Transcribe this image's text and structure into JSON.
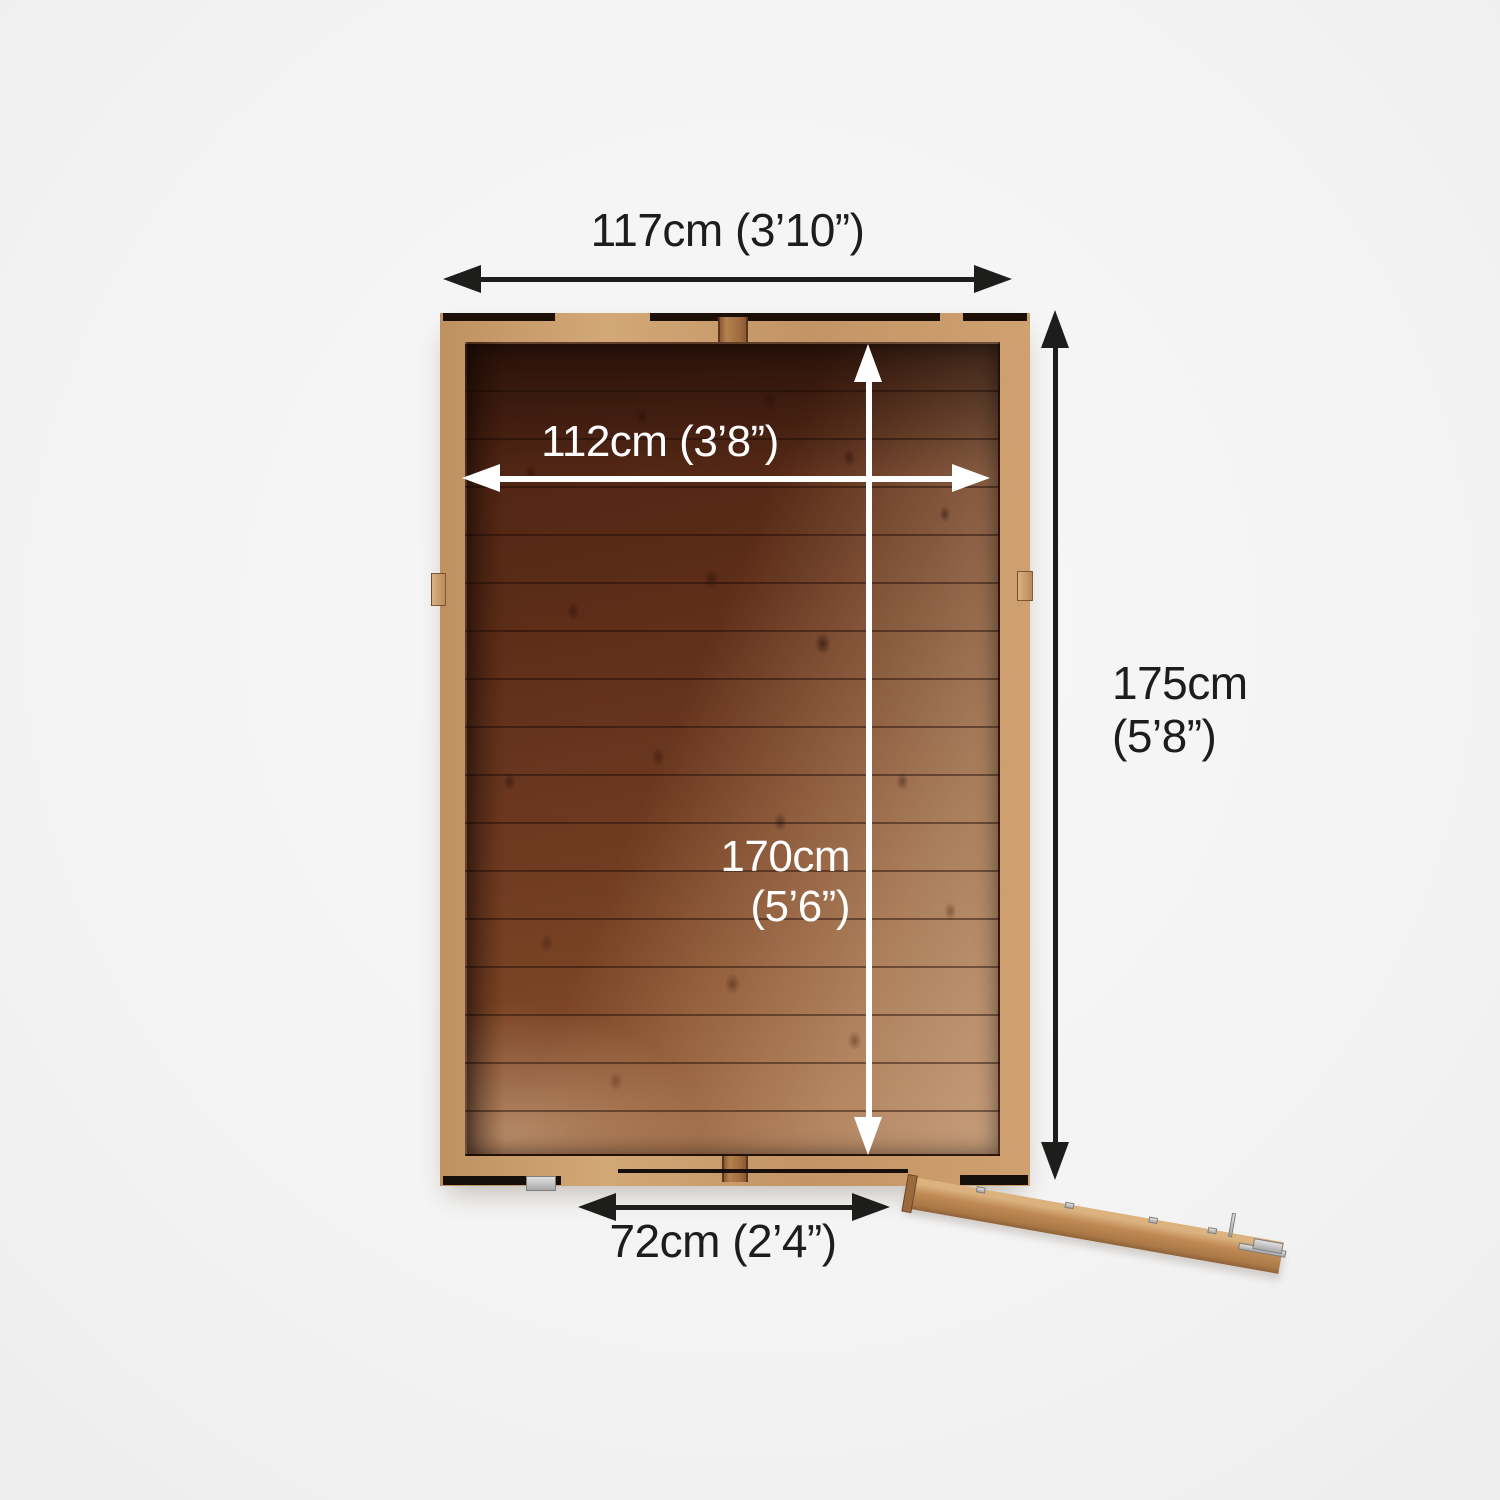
{
  "labels": {
    "external_width": "117cm (3’10”)",
    "internal_width": "112cm (3’8”)",
    "internal_depth_value": "170cm",
    "internal_depth_imperial": "(5’6”)",
    "external_depth_value": "175cm",
    "external_depth_imperial": "(5’8”)",
    "door_width": "72cm (2’4”)"
  },
  "colors": {
    "dimension_dark": "#1d1d1b",
    "dimension_light": "#ffffff",
    "wood_frame": "#c89a6a",
    "wood_interior_dark": "#4a2112",
    "wood_interior_light": "#b97f4f",
    "background": "#f4f4f4"
  }
}
